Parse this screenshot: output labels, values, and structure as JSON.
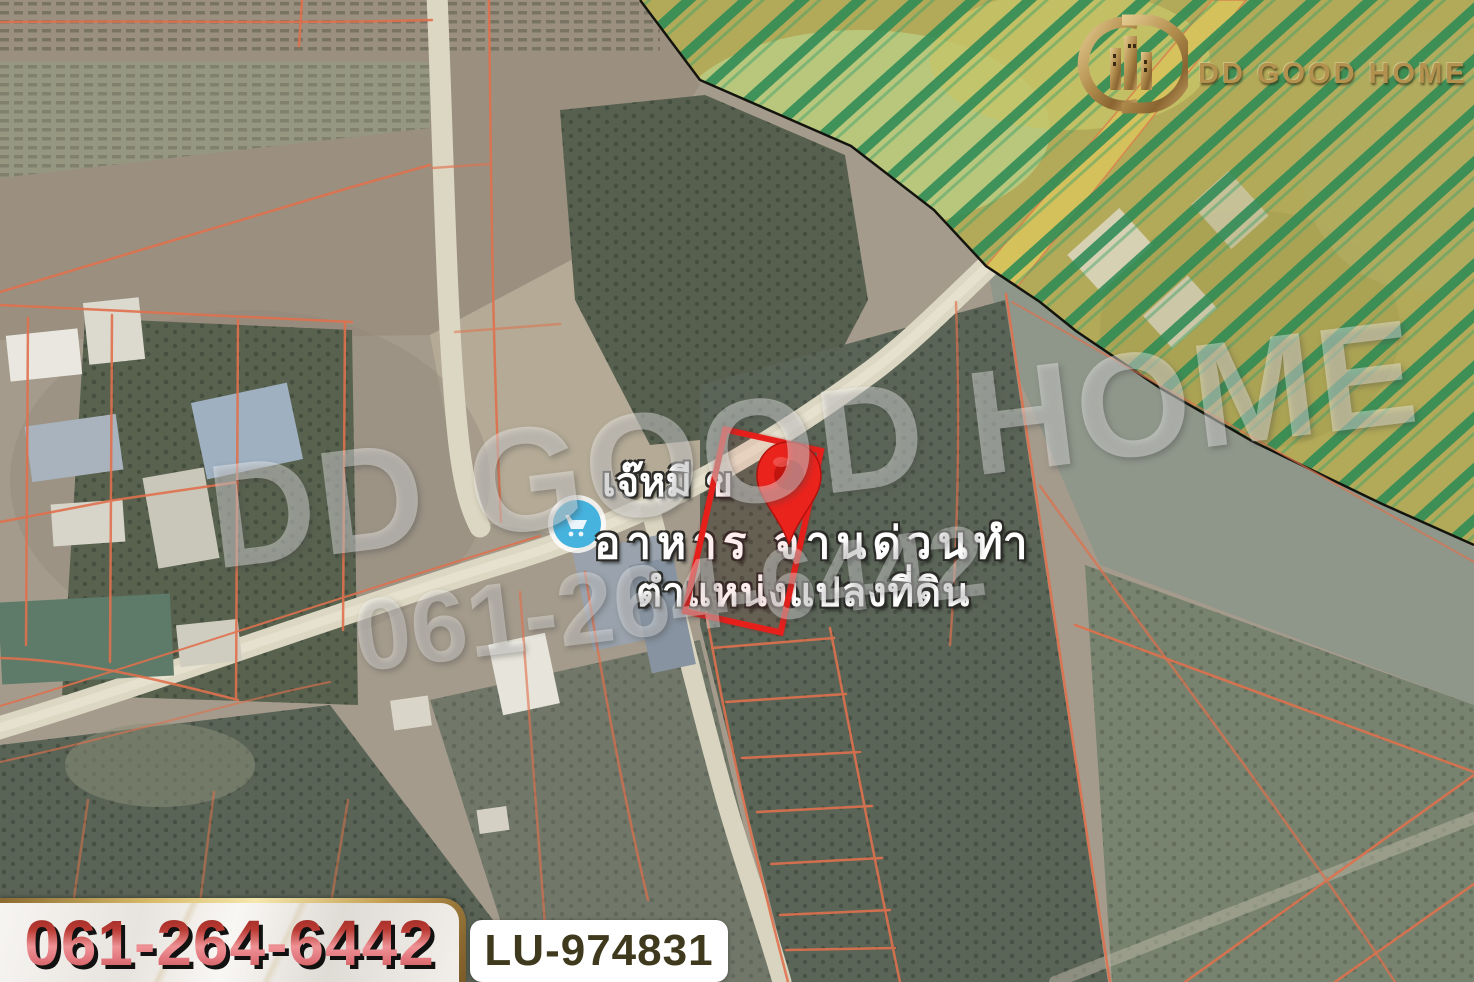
{
  "branding": {
    "logo_text": "DD GOOD HOME",
    "logo_emblem": "dd-buildings-monogram",
    "gold_color": "#b3914f"
  },
  "watermarks": {
    "brand": "DD GOOD HOME",
    "phone": "061-264-6442"
  },
  "map_labels": {
    "poi_name_line1": "เจ๊หมี ข",
    "poi_name_line2": "อาหาร จานด่วนทำ",
    "plot_position": "ตำแหน่งแปลงที่ดิน"
  },
  "map": {
    "marker_icon": "red-location-pin",
    "store_poi_icon": "blue-store-circle",
    "plot_outline_color": "#e71f1a",
    "parcel_line_color": "#e0714d",
    "zone_hatch_color": "#2e8b55",
    "zone_fill_color": "#b2aa58"
  },
  "footer": {
    "phone_number": "061-264-6442",
    "phone_color": "#c0392b",
    "listing_id": "LU-974831"
  }
}
